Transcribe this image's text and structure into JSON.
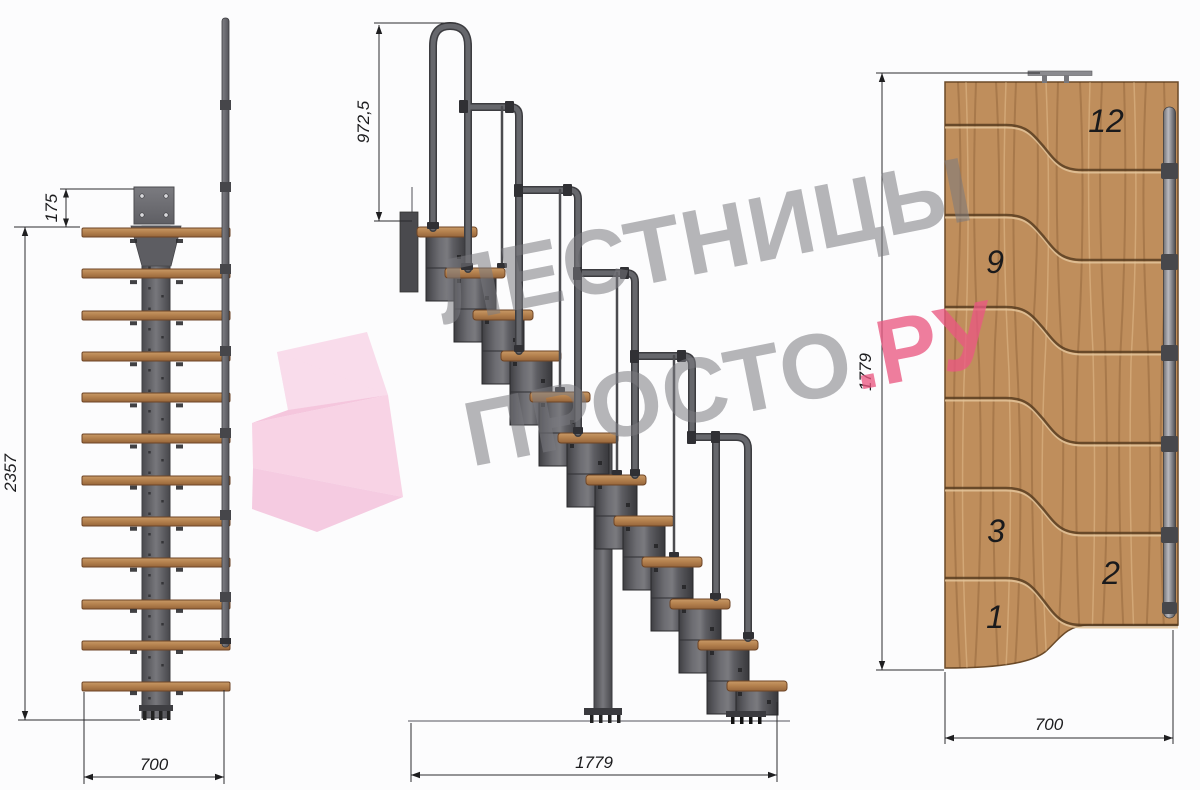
{
  "watermark": {
    "line1": "ЛЕСТНИЦЫ",
    "line2": "ПРОСТО",
    "suffix": ".РУ"
  },
  "front_view": {
    "dim_plate_offset": "175",
    "dim_total_height": "2357",
    "dim_width": "700"
  },
  "side_view": {
    "dim_rail_height": "972,5",
    "dim_total_length": "1779"
  },
  "plan_view": {
    "dim_total_length": "1779",
    "dim_width": "700",
    "step_labels": [
      "12",
      "9",
      "3",
      "2",
      "1"
    ]
  },
  "colors": {
    "wood": "#bd8a57",
    "metal_dark": "#4a4a4e",
    "rail": "#57585c",
    "pink_accent": "#e85c82",
    "watermark_gray": "#7b7b80"
  }
}
